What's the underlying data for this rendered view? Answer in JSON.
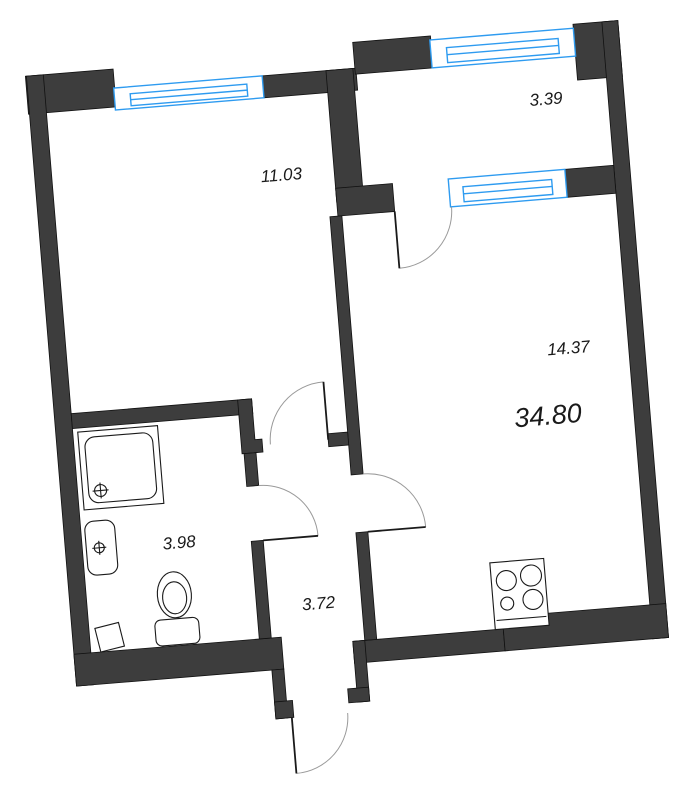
{
  "title": "apartment-floor-plan",
  "total_area": "34.80",
  "rooms": {
    "bedroom": {
      "name": "bedroom",
      "area": "11.03"
    },
    "balcony": {
      "name": "balcony",
      "area": "3.39"
    },
    "living": {
      "name": "living-kitchen",
      "area": "14.37"
    },
    "bathroom": {
      "name": "bathroom",
      "area": "3.98"
    },
    "hall": {
      "name": "hallway",
      "area": "3.72"
    }
  },
  "fixtures": [
    "shower-tray",
    "sink",
    "toilet",
    "stove-4-burners"
  ],
  "openings": {
    "windows": [
      "bedroom-top-window",
      "balcony-top-window",
      "balcony-living-window"
    ],
    "doors": [
      "bedroom-door",
      "bathroom-door",
      "living-door",
      "balcony-door",
      "entrance-door"
    ]
  },
  "colors": {
    "wall": "#3d3d3d",
    "window": "#2e9bf0",
    "door_arc": "#9a9a9a",
    "line": "#1a1a1a",
    "background": "#ffffff"
  }
}
